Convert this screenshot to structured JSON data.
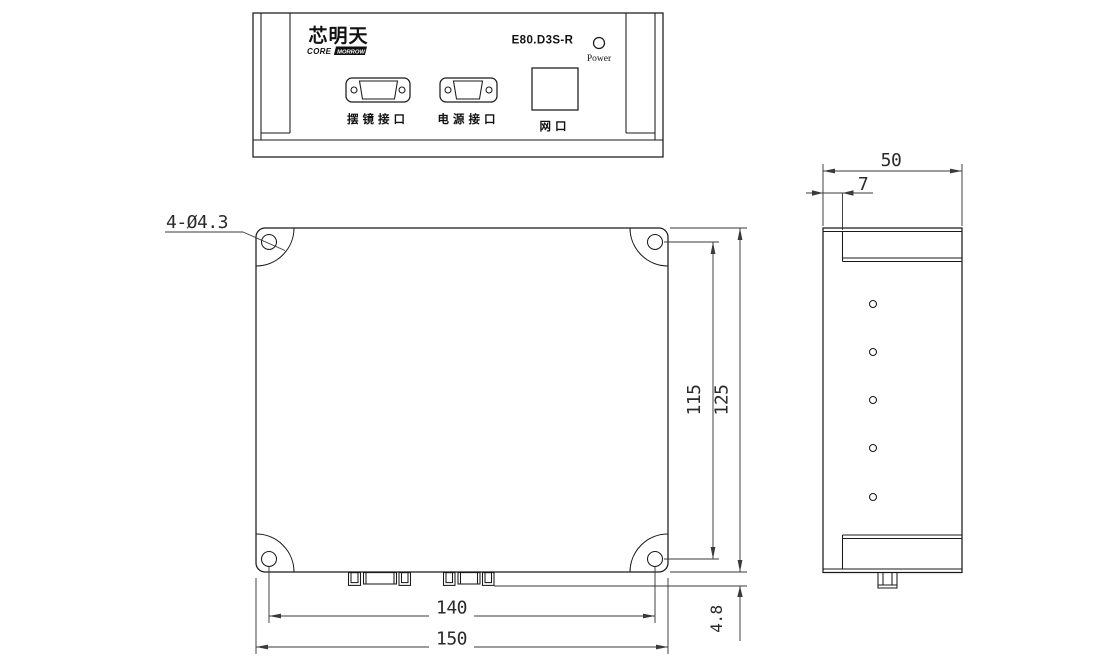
{
  "drawing": {
    "front_view": {
      "logo_text": "芯明天",
      "logo_sub_core": "CORE",
      "logo_sub_morrow": "MORROW",
      "model": "E80.D3S-R",
      "power_label": "Power",
      "connector1_label": "摆镜接口",
      "connector2_label": "电源接口",
      "network_label": "网口"
    },
    "main_view": {
      "hole_callout": "4-Ø4.3",
      "dim_hole_spacing_vertical": "115",
      "dim_body_height": "125",
      "dim_hole_spacing_horizontal": "140",
      "dim_body_width": "150",
      "dim_connector_protrusion": "4.8"
    },
    "side_view": {
      "dim_depth": "50",
      "dim_flange_offset": "7"
    }
  }
}
